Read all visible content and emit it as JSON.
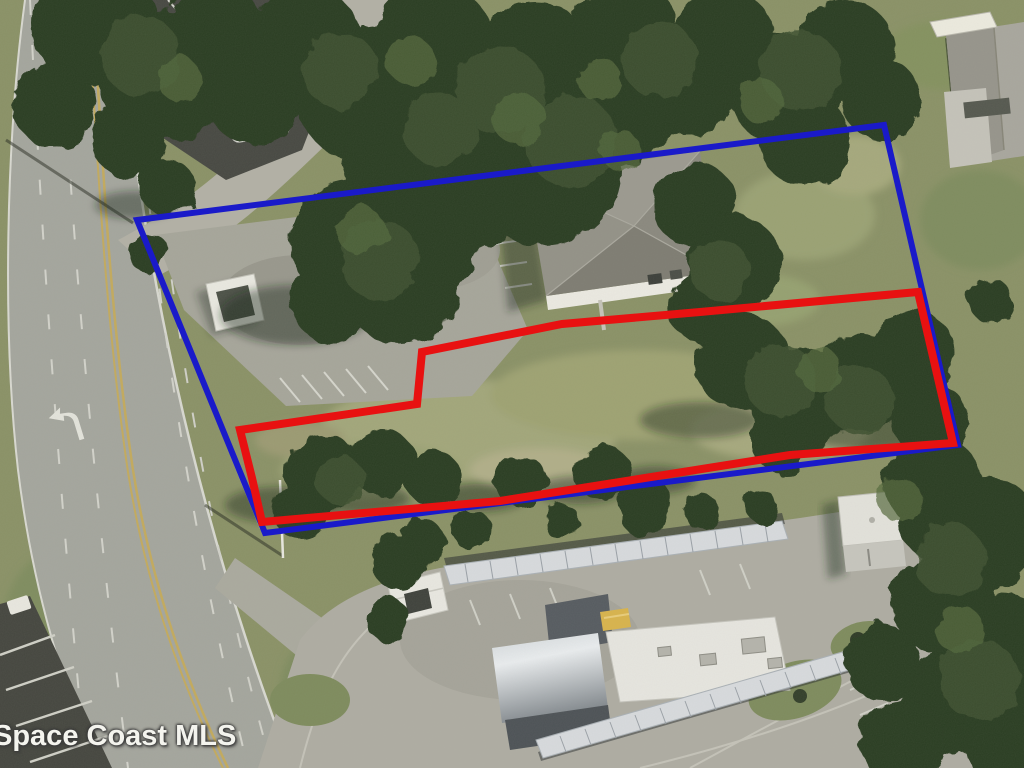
{
  "map": {
    "type": "aerial-photo",
    "description": "Aerial parcel photo with outlined property boundaries",
    "watermark": {
      "text": "Space Coast MLS"
    },
    "boundary_colors": {
      "blue": "#1717c8",
      "red": "#e81111"
    },
    "overlays": [
      {
        "name": "blue-boundary-polygon",
        "color": "#1a1ac9",
        "stroke_width": 6,
        "points": [
          [
            137,
            220
          ],
          [
            884,
            125
          ],
          [
            958,
            445
          ],
          [
            265,
            533
          ]
        ]
      },
      {
        "name": "red-boundary-polygon",
        "color": "#e81111",
        "stroke_width": 8,
        "points": [
          [
            918,
            292
          ],
          [
            700,
            312
          ],
          [
            562,
            324
          ],
          [
            422,
            352
          ],
          [
            417,
            404
          ],
          [
            240,
            430
          ],
          [
            252,
            478
          ],
          [
            262,
            522
          ],
          [
            500,
            501
          ],
          [
            790,
            455
          ],
          [
            953,
            443
          ]
        ]
      }
    ]
  }
}
